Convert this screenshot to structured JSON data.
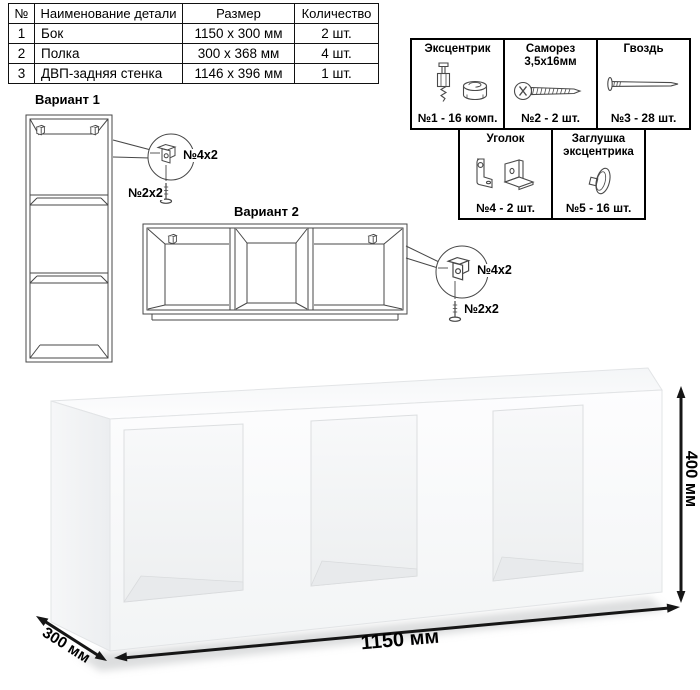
{
  "table": {
    "headers": [
      "№",
      "Наименование детали",
      "Размер",
      "Количество"
    ],
    "rows": [
      [
        "1",
        "Бок",
        "1150 x 300 мм",
        "2 шт."
      ],
      [
        "2",
        "Полка",
        "300 x 368 мм",
        "4 шт."
      ],
      [
        "3",
        "ДВП-задняя стенка",
        "1146 x 396 мм",
        "1 шт."
      ]
    ]
  },
  "hardware": {
    "items": [
      {
        "name": "Эксцентрик",
        "qty": "№1 - 16 комп.",
        "icon": "eccentric-cam-icon"
      },
      {
        "name": "Саморез 3,5х16мм",
        "qty": "№2 - 2 шт.",
        "icon": "self-tapping-screw-icon"
      },
      {
        "name": "Гвоздь",
        "qty": "№3 - 28 шт.",
        "icon": "nail-icon"
      },
      {
        "name": "Уголок",
        "qty": "№4 - 2 шт.",
        "icon": "corner-bracket-icon"
      },
      {
        "name": "Заглушка эксцентрика",
        "qty": "№5 - 16 шт.",
        "icon": "cam-cap-icon"
      }
    ]
  },
  "variants": [
    {
      "title": "Вариант 1",
      "bracket_label": "№4х2",
      "screw_label": "№2х2"
    },
    {
      "title": "Вариант 2",
      "bracket_label": "№4х2",
      "screw_label": "№2х2"
    }
  ],
  "dimensions": {
    "width": "1150 мм",
    "depth": "300 мм",
    "height": "400 мм"
  },
  "colors": {
    "line_art": "#474747",
    "border": "#000000",
    "arrow": "#161616",
    "shelf_shadow": "#b7babc"
  }
}
